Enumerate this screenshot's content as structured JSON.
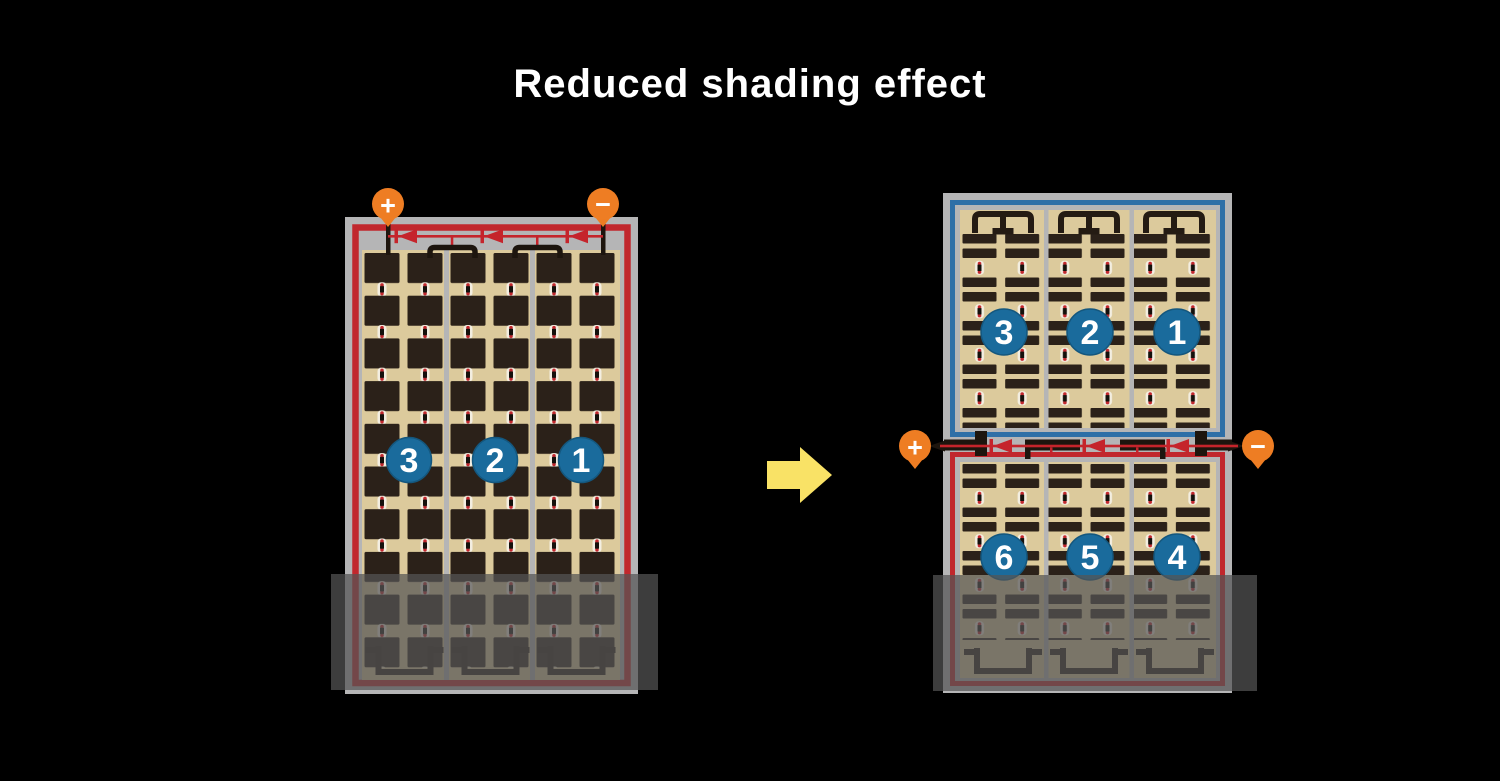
{
  "title": "Reduced shading effect",
  "colors": {
    "background": "#000000",
    "title_text": "#ffffff",
    "frame_gray": "#b5b5b6",
    "panel_tan": "#dcca9c",
    "cell_dark": "#2b2119",
    "border_red": "#c1272d",
    "border_blue": "#2e6fa7",
    "diode_red": "#c5242b",
    "wire_black": "#1d150e",
    "terminal_orange": "#ee7d23",
    "badge_blue": "#1a6b9c",
    "arrow_yellow": "#f9e266",
    "shade_overlay": "rgba(85,85,85,0.72)"
  },
  "left_panel": {
    "terminals": [
      {
        "symbol": "+"
      },
      {
        "symbol": "−"
      }
    ],
    "strings": [
      {
        "number": "3"
      },
      {
        "number": "2"
      },
      {
        "number": "1"
      }
    ]
  },
  "right_assembly": {
    "top_panel": {
      "strings": [
        {
          "number": "3"
        },
        {
          "number": "2"
        },
        {
          "number": "1"
        }
      ]
    },
    "bottom_panel": {
      "strings": [
        {
          "number": "6"
        },
        {
          "number": "5"
        },
        {
          "number": "4"
        }
      ]
    },
    "terminals": [
      {
        "symbol": "+"
      },
      {
        "symbol": "−"
      }
    ]
  }
}
